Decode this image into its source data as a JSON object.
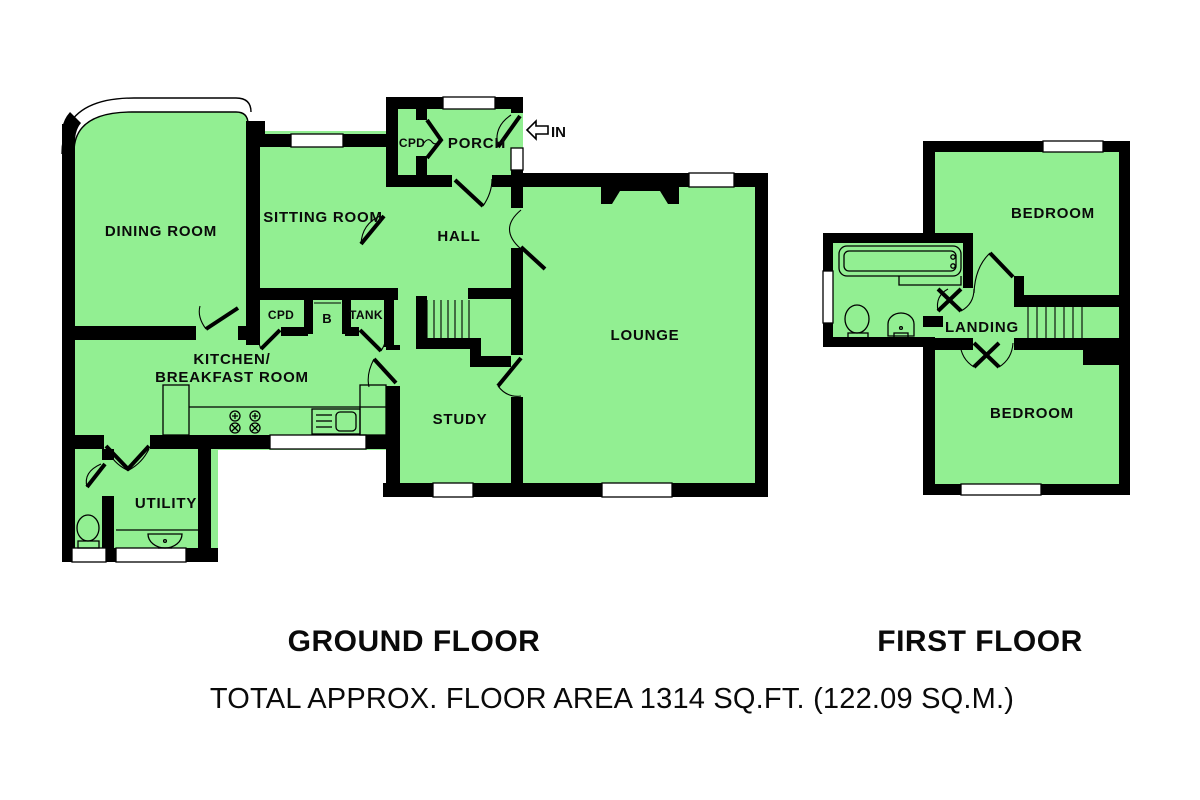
{
  "colors": {
    "floor_fill": "#92EF92",
    "wall": "#000000",
    "background": "#FFFFFF",
    "window_fill": "#FFFFFF"
  },
  "ground_floor": {
    "caption": "GROUND FLOOR",
    "rooms": {
      "dining": "DINING ROOM",
      "sitting": "SITTING ROOM",
      "porch": "PORCH",
      "porch_cupboard": "CPD",
      "hall": "HALL",
      "lounge": "LOUNGE",
      "cupboard": "CPD",
      "boiler": "B",
      "tank": "TANK",
      "kitchen_line1": "KITCHEN/",
      "kitchen_line2": "BREAKFAST ROOM",
      "study": "STUDY",
      "utility": "UTILITY"
    },
    "entrance_label": "IN"
  },
  "first_floor": {
    "caption": "FIRST FLOOR",
    "rooms": {
      "bedroom_front": "BEDROOM",
      "bedroom_back": "BEDROOM",
      "landing": "LANDING"
    }
  },
  "footer": {
    "total_area": "TOTAL APPROX. FLOOR AREA 1314 SQ.FT. (122.09 SQ.M.)"
  }
}
